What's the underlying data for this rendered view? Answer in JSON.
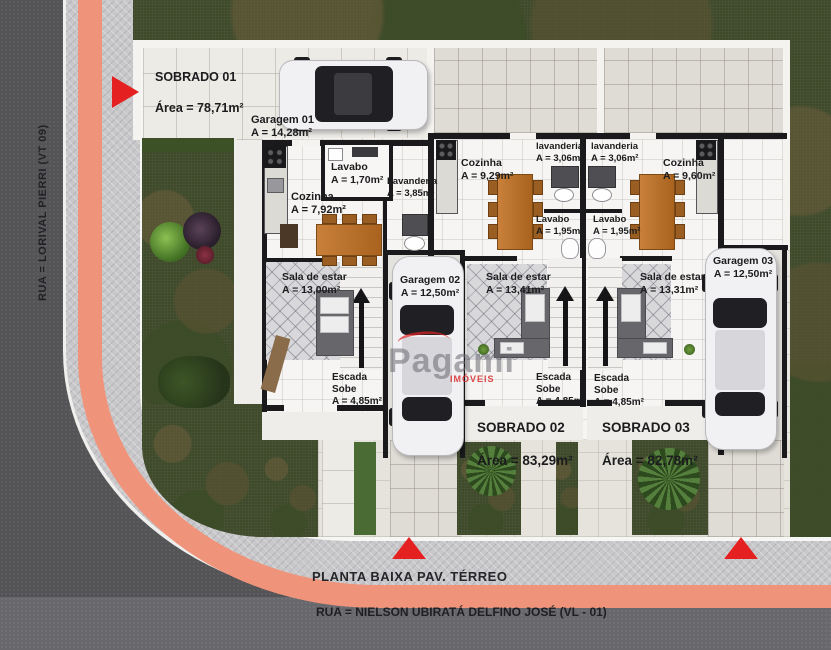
{
  "title": "Planta baixa pavimento térreo - três sobrados",
  "colors": {
    "accent_red": "#e52020",
    "curb_stripe": "#ef947a",
    "grass": "#3f4a2b",
    "asphalt": "#545457"
  },
  "watermark": {
    "brand": "Pagami",
    "sub": "IMÓVEIS"
  },
  "streets": {
    "left_street": "RUA = LORIVAL PIERRI (VT 09)",
    "bottom_street": "RUA = NIELSON UBIRATÁ DELFINO JOSÉ (VL - 01)",
    "plan_caption": "PLANTA BAIXA PAV. TÉRREO"
  },
  "units": [
    {
      "name": "SOBRADO 01",
      "area": "Área = 78,71m²"
    },
    {
      "name": "SOBRADO 02",
      "area": "Área = 83,29m²"
    },
    {
      "name": "SOBRADO 03",
      "area": "Área = 82,78m²"
    }
  ],
  "rooms": {
    "garagem_01": "Garagem 01\nA = 14,28m²",
    "garagem_02": "Garagem 02\nA = 12,50m²",
    "garagem_03": "Garagem 03\nA = 12,50m²",
    "lavabo_01": "Lavabo\nA = 1,70m²",
    "lavanderia_01": "Lavanderia\nA = 3,85m²",
    "cozinha_01": "Cozinha\nA = 7,92m²",
    "cozinha_02": "Cozinha\nA = 9,29m²",
    "cozinha_03": "Cozinha\nA = 9,60m²",
    "lavanderia_02": "lavanderia\nA = 3,06m²",
    "lavanderia_03": "lavanderia\nA = 3,06m²",
    "lavabo_02": "Lavabo\nA = 1,95m²",
    "lavabo_03": "Lavabo\nA = 1,95m²",
    "sala_01": "Sala de estar\nA = 13,00m²",
    "sala_02": "Sala de estar\nA = 13,41m²",
    "sala_03": "Sala de estar\nA = 13,31m²",
    "escada_01": "Escada\nSobe\nA = 4,85m²",
    "escada_02": "Escada\nSobe\nA = 4,85m²",
    "escada_03": "Escada\nSobe\nA = 4,85m²"
  }
}
